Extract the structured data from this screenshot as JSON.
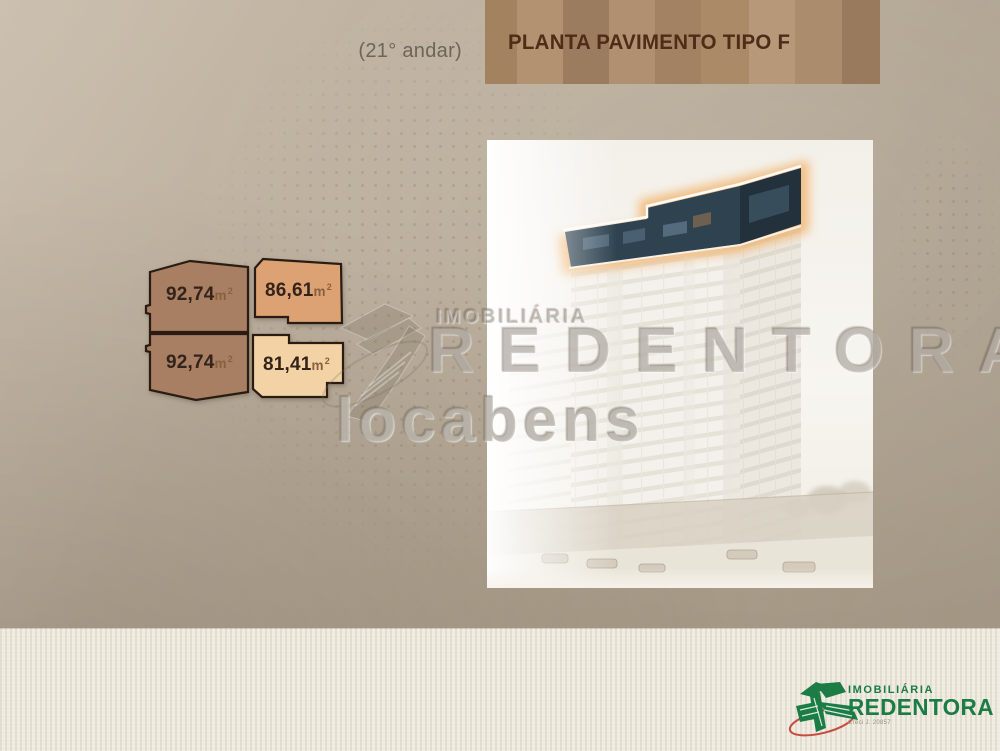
{
  "header": {
    "floor_note": "(21° andar)",
    "title": "PLANTA PAVIMENTO TIPO F",
    "title_color": "#4e2c17",
    "banner_stripes": [
      {
        "w": 32,
        "color": "#a2825f"
      },
      {
        "w": 46,
        "color": "#b39271"
      },
      {
        "w": 46,
        "color": "#9c7c5e"
      },
      {
        "w": 46,
        "color": "#b09071"
      },
      {
        "w": 46,
        "color": "#a28262"
      },
      {
        "w": 48,
        "color": "#ab8a68"
      },
      {
        "w": 46,
        "color": "#b7997a"
      },
      {
        "w": 47,
        "color": "#ab8c6d"
      },
      {
        "w": 38,
        "color": "#9a7a5c"
      }
    ]
  },
  "units": [
    {
      "name": "unit-top-left",
      "area": "92,74",
      "fill": "#a87f63"
    },
    {
      "name": "unit-bottom-left",
      "area": "92,74",
      "fill": "#a87f63"
    },
    {
      "name": "unit-top-right",
      "area": "86,61",
      "fill": "#dda273"
    },
    {
      "name": "unit-bottom-right",
      "area": "81,41",
      "fill": "#f3d3a5"
    }
  ],
  "area_unit": {
    "base": "m",
    "sup": "2"
  },
  "watermarks": {
    "brand_top": "IMOBILIÁRIA",
    "brand_main": "REDENTORA",
    "partner": "locabens"
  },
  "footer_logo": {
    "brand_top": "IMOBILIÁRIA",
    "brand_main": "REDENTORA",
    "creci": "Creci J. 20857",
    "green": "#1b7c45",
    "red": "#c5392c"
  },
  "building": {
    "highlight_floor_color": "#2e4250",
    "highlight_side_color": "#22313c",
    "glow_color": "#f2b26a"
  }
}
